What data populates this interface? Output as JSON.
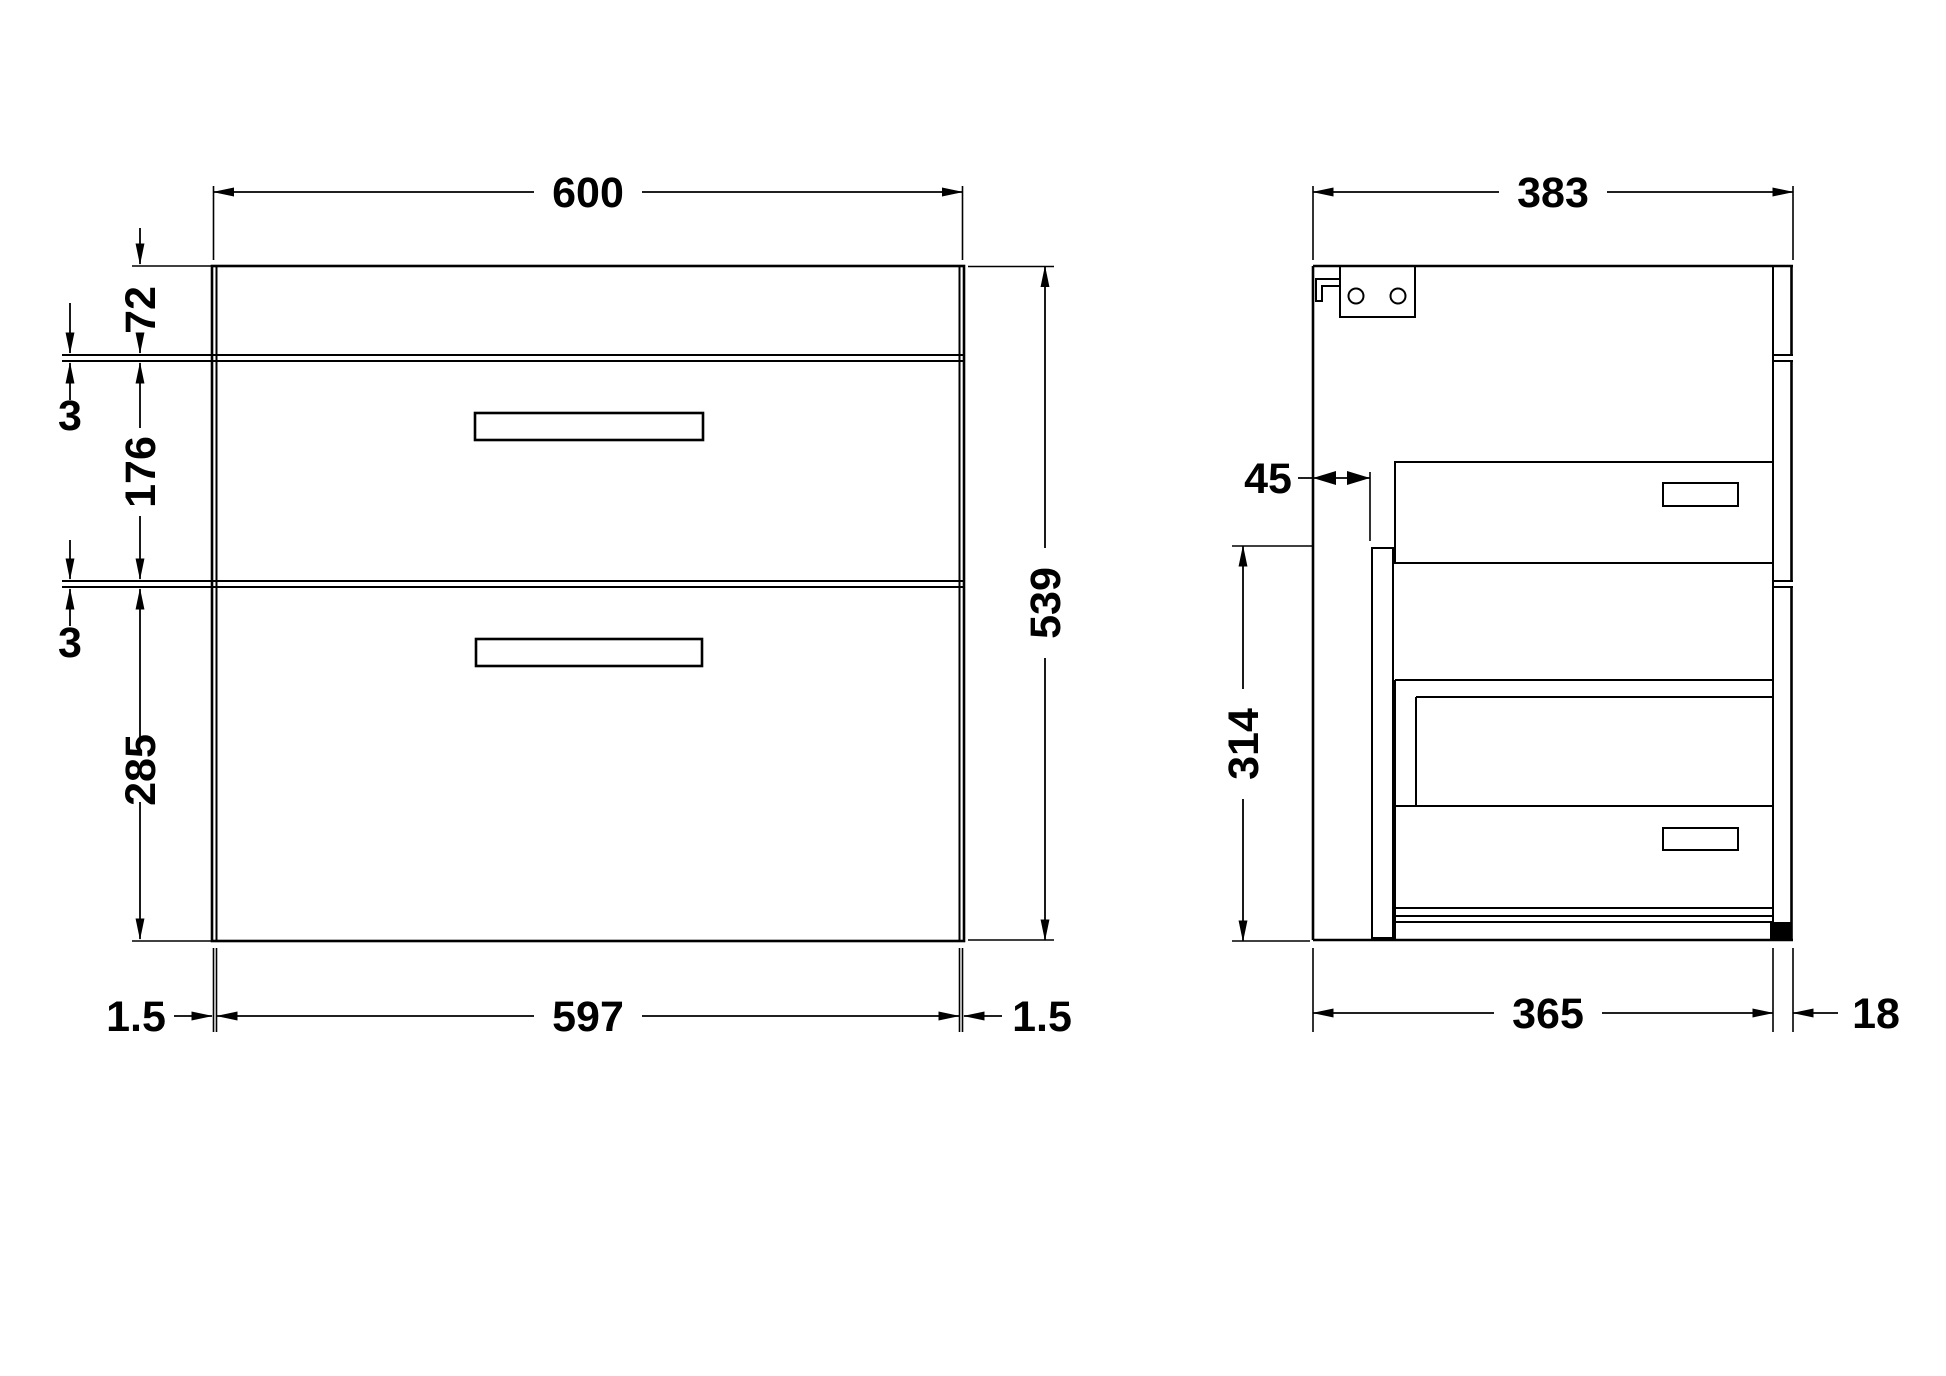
{
  "drawing": {
    "title": "vanity-unit-2-drawer-technical-drawing",
    "front_view": {
      "overall_width": "600",
      "top_band_height": "72",
      "gap_upper": "3",
      "drawer1_height": "176",
      "gap_lower": "3",
      "drawer2_height": "285",
      "overall_height": "539",
      "edge_left": "1.5",
      "inner_width": "597",
      "edge_right": "1.5"
    },
    "side_view": {
      "overall_depth": "383",
      "back_service_gap": "45",
      "internal_height": "314",
      "carcass_depth": "365",
      "front_panel_thickness": "18"
    }
  }
}
